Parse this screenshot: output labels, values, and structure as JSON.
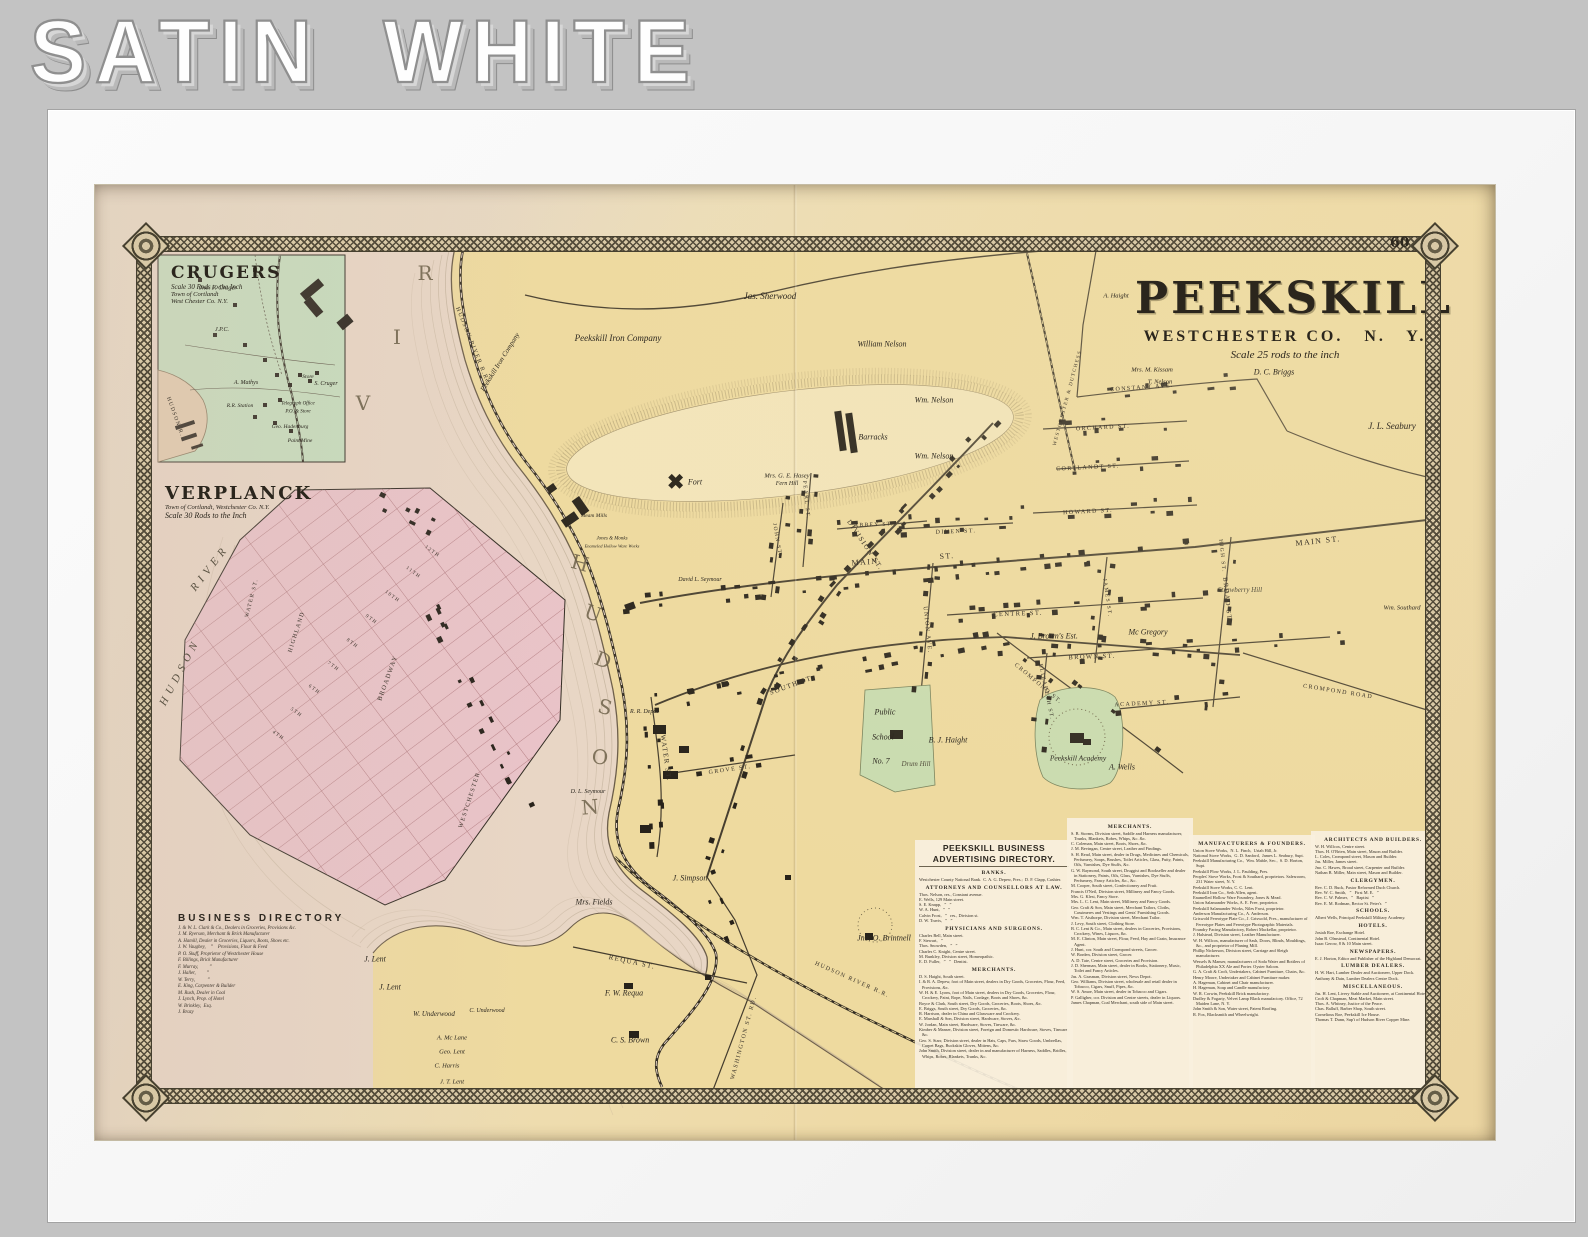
{
  "banner": {
    "title": "SATIN WHITE"
  },
  "page_number": "60",
  "bleed": {
    "text": "PEEKSKILL"
  },
  "map_title": {
    "name": "PEEKSKILL",
    "subtitle": "WESTCHESTER CO.   N.   Y.",
    "scale": "Scale 25 rods to the inch"
  },
  "insets": {
    "crugers": {
      "title": "CRUGERS",
      "scale": "Scale 30 Rods to the Inch",
      "line2": "Town of Cortlandt",
      "line3": "West Chester Co. N.Y."
    },
    "verplanck": {
      "title": "VERPLANCK",
      "line2": "Town of Cortlandt, Westchester Co. N.Y.",
      "scale": "Scale 30 Rods to the Inch"
    }
  },
  "verplanck_directory": {
    "title": "BUSINESS DIRECTORY",
    "entries": [
      "J. & W. L. Clark & Co., Dealers in Groceries, Provisions &c.",
      "J. M. Ryerson, Merchant & Brick Manufacturer",
      "A. Hamill, Dealer in Groceries, Liquors, Boots, Shoes etc.",
      "J. W. Vaughey,    ”    Provisions, Flour & Feed",
      "P. O. Skuff, Proprietor of Westchester House",
      "F. Billings, Brick Manufacturer",
      "F. Murray,         ”",
      "J. Haller,         ”",
      "W. Terry,          ”",
      "E. King, Carpenter & Builder",
      "M. Rush, Dealer in Coal",
      "J. Lynch, Prop. of Hotel",
      "W. Brinkley,  Esq.",
      "J. Brazy"
    ]
  },
  "peekskill_directory": {
    "title": "PEEKSKILL BUSINESS ADVERTISING DIRECTORY.",
    "col1": [
      {
        "h": "BANKS."
      },
      "Westchester County National Bank.  C. A. G. Depew, Pres.;  D. F. Clapp, Cashier.",
      {
        "h": "ATTORNEYS AND COUNSELLORS AT LAW."
      },
      "Thos. Nelson, res., Constant avenue.",
      "E. Wells, 129 Main street.",
      "S. E. Knapp,   ”   ”",
      "W. A. Hunt,   ”   ”",
      "Calvin Frost,   ”   res., Division st.",
      "D. W. Travis,   ”   ”",
      {
        "h": "PHYSICIANS AND SURGEONS."
      },
      "Charles Bell, Main street.",
      "F. Stewart,   ”",
      "Thos. Snowden,   ”   ”",
      "Charles C. Knight, Centre street.",
      "M. Bunkley, Division street, Homeopathic.",
      "E. D. Fuller,   ”   ”   Dentist.",
      {
        "h": "MERCHANTS."
      },
      "D. S. Haight, South street.",
      "I. & R. A. Depew, foot of Main street, dealers in Dry Goods, Groceries, Flour, Feed, Provisions, &c.",
      "W. H. & E. Lyons, foot of Main street, dealers in Dry Goods, Groceries, Flour, Crockery, Paint, Rope, Nails, Cordage, Boots and Shoes, &c.",
      "Boyce & Clark, South street, Dry Goods, Groceries, Boots, Shoes, &c.",
      "E. Briggs, South street, Dry Goods, Groceries, &c.",
      "R. Harrison, dealer in China and Glassware and Crockery.",
      "E. Marshall & Son, Division street, Hardware, Stoves, &c.",
      "W. Jordan, Main street, Hardware, Stoves, Tinware, &c.",
      "Kimber & Manser, Division street, Foreign and Domestic Hardware, Stoves, Tinware, &c.",
      "Geo. S. Starr, Division street, dealer in Hats, Caps, Furs, Straw Goods, Umbrellas, Carpet Bags, Buckskin Gloves, Mittens, &c.",
      "John Smith, Division street, dealer in and manufacturer of Harness, Saddles, Bridles, Whips, Robes, Blankets, Trunks, &c."
    ],
    "col2": [
      {
        "h": "MERCHANTS."
      },
      "S. B. Storms, Division street, Saddle and Harness manufacturer, Trunks, Blankets, Robes, Whips, &c. &c.",
      "C. Coleman, Main street, Boots, Shoes, &c.",
      "J. M. Bevingan, Centre street, Leather and Findings.",
      "S. H. Read, Main street, dealer in Drugs, Medicines and Chemicals, Perfumery, Soaps, Brushes, Toilet Articles, Glass, Putty, Paints, Oils, Varnishes, Dye Stuffs, &c.",
      "G. W. Raymond, South street, Druggist and Bookseller and dealer in Stationery, Paints, Oils, Glass, Varnishes, Dye Stuffs, Perfumery, Fancy Articles, &c., &c.",
      "M. Cooper, South street, Confectionery and Fruit.",
      "Francis O'Neil, Division street, Millinery and Fancy Goods.",
      "Mrs. G. Klest, Fancy Store.",
      "Mrs. L. C. Lent, Main street, Millinery and Fancy Goods.",
      "Geo. Craft & Son, Main street, Merchant Tailors, Cloths, Cassimeres and Vestings and Gents' Furnishing Goods.",
      "Wm. T. Aisthorpe, Division street, Merchant Tailor.",
      "J. Levy, South street, Clothing Store.",
      "B. C. Lent & Co., Main street, dealers in Groceries, Provisions, Crockery, Wines, Liquors, &c.",
      "M. E. Clinton, Main street, Flour, Feed, Hay and Grain, Insurance Agent.",
      "J. Hunt, cor. South and Crompond streets, Grocer.",
      "W. Borden, Division street, Grocer.",
      "A. D. Tate, Centre street, Groceries and Provision.",
      "J. D. Sherman, Main street, dealer in Books, Stationery, Music, Toilet and Fancy Articles.",
      "Jas. A. Grasman, Division street, News Depot.",
      "Geo. Williams, Division street, wholesale and retail dealer in Tobacco, Cigars, Snuff, Pipes, &c.",
      "W. S. Amoe, Main street, dealer in Tobacco and Cigars.",
      "P. Galligher, cor. Division and Centre streets, dealer in Liquors.",
      "James Chapman, Coal Merchant, south side of Main street."
    ],
    "col3": [
      {
        "h": "MANUFACTURERS & FOUNDERS."
      },
      "Union Stove Works,  N. L. Finch,  Uriah Hill, Jr.",
      "National Stove Works,  G. D. Sanford,  James L. Seabury, Supt.",
      "Peekskill Manufacturing Co.,  Wm. Mable, Sec.,  S. D. Horton, Supt.",
      "Peekskill Plow Works, J. L. Paulding, Pres.",
      "Peoples' Stove Works, Frost & Southard, proprietors. Salesroom, 231 Water street, N. Y.",
      "Peekskill Stove Works, C. C. Lent.",
      "Peekskill Iron Co., Seth Allen, agent.",
      "Enamelled Hollow Ware Foundery, Jones & Mead.",
      "Union Salamander Works, A. E. Free, proprietor.",
      "Peekskill Salamander Works, Niles Frost, proprietor.",
      "Anderson Manufacturing Co., A. Anderson.",
      "Griswold Fereotype Plate Co., J. Griswold, Pres., manufacturer of Fereotype Plates and Fereotype Photographic Materials.",
      "Foundry Facing Manufactory, Robert Mackellar, proprietor.",
      "J. Halstead, Division street, Leather Manufacturer.",
      "W. H. Willcox, manufacturer of Sash, Doors, Blinds, Mouldings, &c., and proprietor of Planing Mill.",
      "Phillip Nickerson, Division street, Carriage and Sleigh manufacturer.",
      "Wessels & Manser, manufacturers of Soda Water and Bottlers of Philadelphia XX Ale and Porter. Oyster Saloon.",
      "G. A. Craft & Croft, Undertakers, Cabinet Furniture, Chairs, &c.",
      "Henry Moore, Undertaker and Cabinet Furniture maker.",
      "A. Hageman, Cabinet and Chair manufacturer.",
      "H. Hageman, Soap and Candle manufactory.",
      "W. R. Corwin, Peekskill Brick manufactory.",
      "Dudley & Fogarty, Velvet Lamp Black manufactory. Office, 72 Maiden Lane, N. Y.",
      "John Smith & Son, Water street, Patent Roofing.",
      "R. Fox, Blacksmith and Wheelwright."
    ],
    "col4": [
      {
        "h": "ARCHITECTS AND BUILDERS."
      },
      "W. H. Willcox, Centre street.",
      "Thos. H. O'Brien, Main street, Mason and Builder.",
      "L. Coles, Crompond street, Mason and Builder.",
      "Jas. Miller, James street.",
      "Jno. C. Hawes, Broad street, Carpenter and Builder.",
      "Nathan B. Miller, Main street, Mason and Builder.",
      {
        "h": "CLERGYMEN."
      },
      "Rev. C. D. Buck, Pastor Reformed Duch Church.",
      "Rev. W. C. Smith,   ”   First M. E.   ”",
      "Rev. C. W. Palmer,   ”   Baptist   ”",
      "Rev. E. M. Rodman, Rector St. Peter's   ”",
      {
        "h": "SCHOOLS."
      },
      "Albert Wells, Principal Peekskill Military Academy.",
      {
        "h": "HOTELS."
      },
      "Josiah Roe, Exchange Hotel.",
      "John B. Olmstead, Continental Hotel.",
      "Isaac Gerow, 8 & 10 Main street.",
      {
        "h": "NEWSPAPERS."
      },
      "E. J. Horton, Editor and Publisher of the Highland Democrat.",
      {
        "h": "LUMBER DEALERS."
      },
      "H. W. Hart, Lumber Dealer and Auctioneer, Upper Dock.",
      "Anthony & Dain, Lumber Dealers Centre Dock.",
      {
        "h": "MISCELLANEOUS."
      },
      "Jas. H. Lent, Livery Stable and Auctioneer, at Continental Hotel.",
      "Croft & Chapman, Meat Market, Main street.",
      "Thos. A. Whitney, Justice of the Peace.",
      "Chas. Balluff, Barber Shop, South street.",
      "Cornelious Roe, Peekskill Ice House.",
      "Thomas T. Dunn, Sup't of Hudson River Copper Mine."
    ]
  },
  "map_labels": [
    {
      "t": "R",
      "x": 330,
      "y": 88,
      "c": "big"
    },
    {
      "t": "I",
      "x": 302,
      "y": 152,
      "c": "big"
    },
    {
      "t": "V",
      "x": 268,
      "y": 218,
      "c": "big"
    },
    {
      "t": "H",
      "x": 485,
      "y": 378,
      "r": 15,
      "c": "big"
    },
    {
      "t": "U",
      "x": 498,
      "y": 428,
      "r": 20,
      "c": "big"
    },
    {
      "t": "D",
      "x": 508,
      "y": 475,
      "r": 22,
      "c": "big"
    },
    {
      "t": "S",
      "x": 510,
      "y": 522,
      "r": 15,
      "c": "big"
    },
    {
      "t": "O",
      "x": 505,
      "y": 572,
      "r": 5,
      "c": "big"
    },
    {
      "t": "N",
      "x": 495,
      "y": 622,
      "r": -5,
      "c": "big"
    },
    {
      "t": "Jas. Sherwood",
      "x": 675,
      "y": 111,
      "c": "n",
      "s": 9
    },
    {
      "t": "Peekskill Iron Company",
      "x": 523,
      "y": 153,
      "c": "n",
      "s": 9
    },
    {
      "t": "Peekskill Iron Company",
      "x": 405,
      "y": 177,
      "r": -58,
      "c": "n",
      "s": 7
    },
    {
      "t": "William Nelson",
      "x": 787,
      "y": 159,
      "c": "n"
    },
    {
      "t": "Wm. Nelson",
      "x": 839,
      "y": 215,
      "c": "n"
    },
    {
      "t": "Wm. Nelson",
      "x": 839,
      "y": 271,
      "c": "n"
    },
    {
      "t": "Mrs. G. E. Hasey",
      "x": 692,
      "y": 291,
      "c": "tiny",
      "s": 6.5
    },
    {
      "t": "Fern Hill",
      "x": 692,
      "y": 299,
      "c": "tiny",
      "s": 6
    },
    {
      "t": "J. L. Seabury",
      "x": 1297,
      "y": 241,
      "c": "n",
      "s": 9
    },
    {
      "t": "D. C. Briggs",
      "x": 1179,
      "y": 187,
      "c": "n"
    },
    {
      "t": "Mrs. M. Kissam",
      "x": 1057,
      "y": 185,
      "c": "tiny",
      "s": 6.5
    },
    {
      "t": "T. Nelson",
      "x": 1065,
      "y": 197,
      "c": "tiny",
      "s": 6.5
    },
    {
      "t": "A. Haight",
      "x": 1021,
      "y": 111,
      "c": "tiny",
      "s": 6.5
    },
    {
      "t": "J. Brown's Est.",
      "x": 959,
      "y": 451,
      "c": "n"
    },
    {
      "t": "Mc Gregory",
      "x": 1053,
      "y": 447,
      "c": "n"
    },
    {
      "t": "Strawberry Hill",
      "x": 1145,
      "y": 405,
      "c": "hill"
    },
    {
      "t": "Wm. Southard",
      "x": 1307,
      "y": 423,
      "c": "tiny",
      "s": 6.5
    },
    {
      "t": "J. Simpson",
      "x": 595,
      "y": 693,
      "c": "n"
    },
    {
      "t": "Mrs. Fields",
      "x": 499,
      "y": 717,
      "c": "n"
    },
    {
      "t": "Jno. O. Brintnell",
      "x": 789,
      "y": 753,
      "c": "n"
    },
    {
      "t": "F. W. Requa",
      "x": 529,
      "y": 808,
      "c": "n"
    },
    {
      "t": "C. S. Brown",
      "x": 535,
      "y": 855,
      "c": "n"
    },
    {
      "t": "J. Lent",
      "x": 280,
      "y": 774,
      "c": "n"
    },
    {
      "t": "J. Lent",
      "x": 295,
      "y": 802,
      "c": "n"
    },
    {
      "t": "W. Underwood",
      "x": 339,
      "y": 829,
      "c": "n",
      "s": 7
    },
    {
      "t": "C. Underwood",
      "x": 392,
      "y": 826,
      "c": "tiny",
      "s": 6
    },
    {
      "t": "A. Mc Lane",
      "x": 357,
      "y": 853,
      "c": "tiny",
      "s": 6.5
    },
    {
      "t": "Geo. Lent",
      "x": 357,
      "y": 867,
      "c": "tiny",
      "s": 6.5
    },
    {
      "t": "C. Harris",
      "x": 352,
      "y": 881,
      "c": "tiny",
      "s": 6.5
    },
    {
      "t": "J. T. Lent",
      "x": 357,
      "y": 897,
      "c": "tiny",
      "s": 6.5
    },
    {
      "t": "B. J. Haight",
      "x": 853,
      "y": 555,
      "c": "n"
    },
    {
      "t": "Drum Hill",
      "x": 821,
      "y": 579,
      "c": "hill"
    },
    {
      "t": "A. Wells",
      "x": 1027,
      "y": 582,
      "c": "n"
    },
    {
      "t": "Barracks",
      "x": 778,
      "y": 252,
      "c": "n",
      "s": 8
    },
    {
      "t": "Fort",
      "x": 600,
      "y": 297,
      "c": "n",
      "s": 8
    },
    {
      "t": "R. R. Depot",
      "x": 549,
      "y": 527,
      "c": "tiny",
      "s": 6
    },
    {
      "t": "David L. Seymour",
      "x": 605,
      "y": 395,
      "c": "tiny",
      "s": 6
    },
    {
      "t": "D. L. Seymour",
      "x": 493,
      "y": 607,
      "c": "tiny",
      "s": 6
    },
    {
      "t": "Jones & Monks",
      "x": 517,
      "y": 354,
      "c": "tiny",
      "s": 5
    },
    {
      "t": "Enameled Hollow Ware Works",
      "x": 517,
      "y": 361,
      "c": "tiny",
      "s": 4.5
    },
    {
      "t": "Steam Mills",
      "x": 499,
      "y": 331,
      "c": "tiny",
      "s": 5.5
    },
    {
      "t": "Public",
      "x": 790,
      "y": 527,
      "c": "n",
      "s": 8
    },
    {
      "t": "School",
      "x": 788,
      "y": 552,
      "c": "n",
      "s": 8
    },
    {
      "t": "No. 7",
      "x": 786,
      "y": 576,
      "c": "n",
      "s": 8
    },
    {
      "t": "Peekskill Academy",
      "x": 983,
      "y": 573,
      "c": "n",
      "s": 7.5
    },
    {
      "t": "MAIN",
      "x": 770,
      "y": 377,
      "r": -4,
      "c": "st",
      "s": 8
    },
    {
      "t": "ST.",
      "x": 852,
      "y": 371,
      "r": -4,
      "c": "st",
      "s": 8
    },
    {
      "t": "MAIN  ST.",
      "x": 1223,
      "y": 356,
      "r": -6,
      "c": "st",
      "s": 8
    },
    {
      "t": "DIVISION  ST.",
      "x": 770,
      "y": 360,
      "r": 56,
      "c": "st"
    },
    {
      "t": "SOUTH ST.",
      "x": 697,
      "y": 500,
      "r": -20,
      "c": "st"
    },
    {
      "t": "WATER ST.",
      "x": 571,
      "y": 573,
      "r": 82,
      "c": "st"
    },
    {
      "t": "UNION AVE.",
      "x": 832,
      "y": 445,
      "r": 84,
      "c": "st",
      "s": 6
    },
    {
      "t": "DIVEN ST.",
      "x": 861,
      "y": 347,
      "r": -2,
      "c": "st",
      "s": 6
    },
    {
      "t": "HOWARD ST.",
      "x": 993,
      "y": 327,
      "r": -3,
      "c": "st",
      "s": 6
    },
    {
      "t": "ORCHARD ST.",
      "x": 1008,
      "y": 243,
      "r": -3,
      "c": "st",
      "s": 6
    },
    {
      "t": "CONSTANT AVE.",
      "x": 1047,
      "y": 203,
      "r": -4,
      "c": "st",
      "s": 6
    },
    {
      "t": "CORTLANDT ST.",
      "x": 993,
      "y": 283,
      "r": -3,
      "c": "st",
      "s": 6
    },
    {
      "t": "CENTRE ST.",
      "x": 923,
      "y": 429,
      "r": -2,
      "c": "st",
      "s": 6.5
    },
    {
      "t": "BROWN ST.",
      "x": 997,
      "y": 472,
      "r": -2,
      "c": "st",
      "s": 6.5
    },
    {
      "t": "BROAD ST.",
      "x": 1132,
      "y": 415,
      "r": 84,
      "c": "st",
      "s": 6.5
    },
    {
      "t": "ACADEMY ST.",
      "x": 1047,
      "y": 519,
      "r": -3,
      "c": "st",
      "s": 6
    },
    {
      "t": "CROMPOND ST.",
      "x": 943,
      "y": 499,
      "r": 40,
      "c": "st",
      "s": 6
    },
    {
      "t": "JAMES ST.",
      "x": 1012,
      "y": 413,
      "r": 82,
      "c": "st",
      "s": 5.5
    },
    {
      "t": "ELIZABETH ST.",
      "x": 951,
      "y": 507,
      "r": 78,
      "c": "st",
      "s": 5.5
    },
    {
      "t": "JOHN ST.",
      "x": 682,
      "y": 355,
      "r": 80,
      "c": "st",
      "s": 5.5
    },
    {
      "t": "PEARL ST.",
      "x": 711,
      "y": 315,
      "r": 84,
      "c": "st",
      "s": 5.5
    },
    {
      "t": "GROVE ST.",
      "x": 635,
      "y": 585,
      "r": -8,
      "c": "st",
      "s": 6
    },
    {
      "t": "ABBEY ST.",
      "x": 779,
      "y": 340,
      "r": -2,
      "c": "st",
      "s": 5.5
    },
    {
      "t": "HIGH ST.",
      "x": 1127,
      "y": 371,
      "r": 84,
      "c": "st",
      "s": 5.5
    },
    {
      "t": "REQUA ST.",
      "x": 537,
      "y": 777,
      "r": 12,
      "c": "st"
    },
    {
      "t": "WASHINGTON ST. RD.",
      "x": 649,
      "y": 853,
      "r": -75,
      "c": "st",
      "s": 6
    },
    {
      "t": "CROMPOND ROAD",
      "x": 1243,
      "y": 507,
      "r": 9,
      "c": "st",
      "s": 6
    },
    {
      "t": "HUDSON RIVER R.R.",
      "x": 377,
      "y": 160,
      "r": 68,
      "c": "st",
      "s": 6
    },
    {
      "t": "HUDSON RIVER R.R.",
      "x": 757,
      "y": 795,
      "r": 24,
      "c": "st",
      "s": 6
    },
    {
      "t": "WESTCHESTER & DUTCHESS",
      "x": 973,
      "y": 213,
      "r": -75,
      "c": "st",
      "s": 5
    },
    {
      "t": "Jno. F. Cruger",
      "x": 123,
      "y": 103,
      "c": "tiny",
      "s": 6.5
    },
    {
      "t": "J.P.C.",
      "x": 127,
      "y": 145,
      "c": "tiny",
      "s": 6
    },
    {
      "t": "A. Mathys",
      "x": 151,
      "y": 198,
      "c": "tiny",
      "s": 6
    },
    {
      "t": "R.R. Station",
      "x": 145,
      "y": 221,
      "c": "tiny",
      "s": 5.5
    },
    {
      "t": "Telegraph Office",
      "x": 203,
      "y": 219,
      "c": "tiny",
      "s": 5
    },
    {
      "t": "P.O. & Store",
      "x": 203,
      "y": 227,
      "c": "tiny",
      "s": 5
    },
    {
      "t": "Geo. Hadenburg",
      "x": 195,
      "y": 242,
      "c": "tiny",
      "s": 5.5
    },
    {
      "t": "Paint Mine",
      "x": 205,
      "y": 256,
      "c": "tiny",
      "s": 5.5
    },
    {
      "t": "Store",
      "x": 213,
      "y": 192,
      "c": "tiny",
      "s": 5.5
    },
    {
      "t": "S. Cruger",
      "x": 231,
      "y": 199,
      "c": "tiny",
      "s": 6
    },
    {
      "t": "HUDSON R.",
      "x": 80,
      "y": 232,
      "r": 70,
      "c": "st",
      "s": 5.5
    },
    {
      "t": "RIVER",
      "x": 115,
      "y": 383,
      "r": -52,
      "c": "riv"
    },
    {
      "t": "HUDSON",
      "x": 85,
      "y": 487,
      "r": -62,
      "c": "riv"
    },
    {
      "t": "WATER ST.",
      "x": 157,
      "y": 413,
      "r": -76,
      "c": "st",
      "s": 5.5
    },
    {
      "t": "HIGHLAND",
      "x": 202,
      "y": 447,
      "r": -72,
      "c": "st",
      "s": 6
    },
    {
      "t": "BROADWAY",
      "x": 293,
      "y": 493,
      "r": -70,
      "c": "st",
      "s": 6.5
    },
    {
      "t": "WESTCHESTER",
      "x": 375,
      "y": 615,
      "r": -72,
      "c": "st",
      "s": 6
    },
    {
      "t": "12TH",
      "x": 337,
      "y": 367,
      "r": 36,
      "c": "st",
      "s": 5
    },
    {
      "t": "11TH",
      "x": 318,
      "y": 388,
      "r": 36,
      "c": "st",
      "s": 5
    },
    {
      "t": "10TH",
      "x": 297,
      "y": 412,
      "r": 36,
      "c": "st",
      "s": 5
    },
    {
      "t": "9TH",
      "x": 276,
      "y": 435,
      "r": 36,
      "c": "st",
      "s": 5
    },
    {
      "t": "8TH",
      "x": 257,
      "y": 459,
      "r": 36,
      "c": "st",
      "s": 5
    },
    {
      "t": "7TH",
      "x": 238,
      "y": 482,
      "r": 36,
      "c": "st",
      "s": 5
    },
    {
      "t": "6TH",
      "x": 219,
      "y": 505,
      "r": 36,
      "c": "st",
      "s": 5
    },
    {
      "t": "5TH",
      "x": 201,
      "y": 528,
      "r": 36,
      "c": "st",
      "s": 5
    },
    {
      "t": "4TH",
      "x": 183,
      "y": 551,
      "r": 36,
      "c": "st",
      "s": 5
    }
  ]
}
